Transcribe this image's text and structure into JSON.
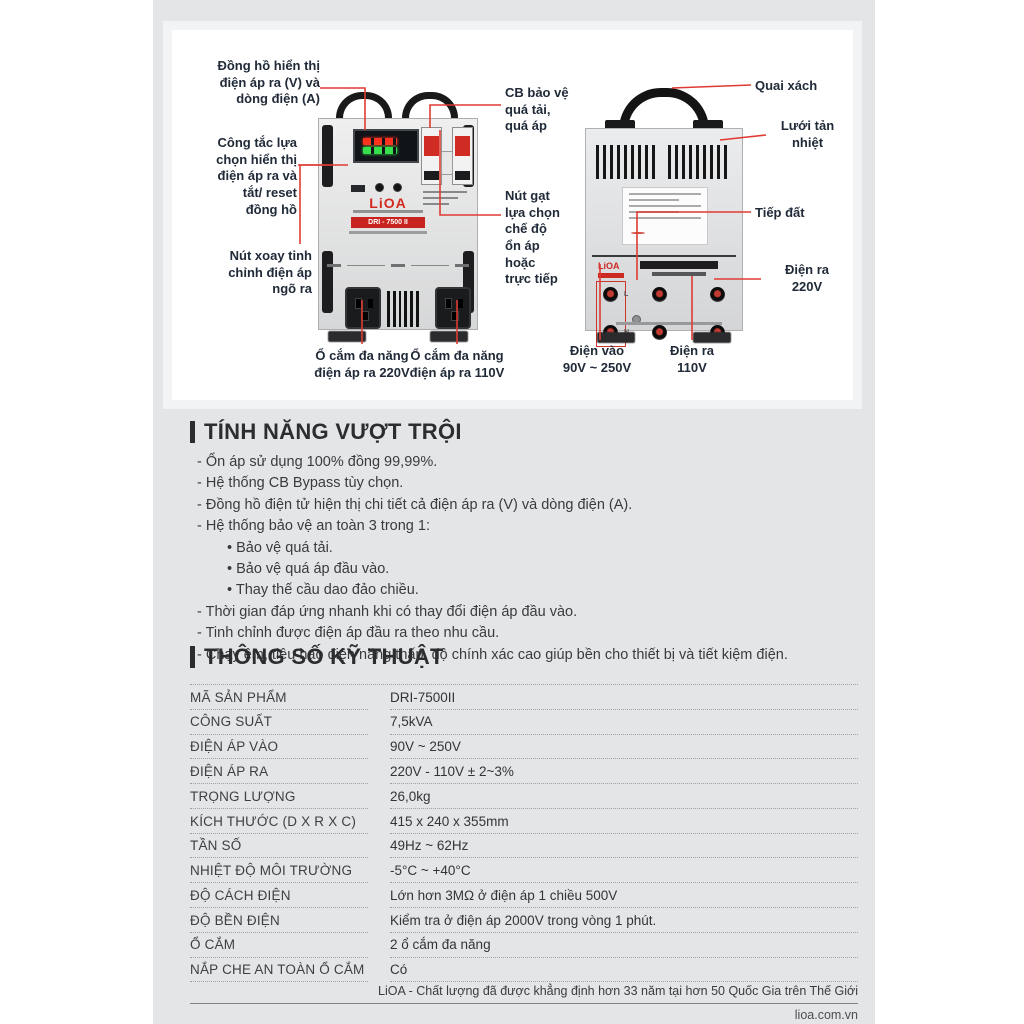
{
  "colors": {
    "accent_red": "#df3b33",
    "annotation_navy": "#202a38",
    "panel_gray": "#e4e5e7",
    "heading_dark": "#2b2d2f"
  },
  "device": {
    "front_logo": "LiOA",
    "front_model": "DRI - 7500 II",
    "back_logo": "LiOA"
  },
  "annotations": {
    "meter": "Đồng hồ hiển thị\nđiện áp ra (V) và\ndòng điện (A)",
    "selector_switch": "Công tắc lựa\nchọn hiển thị\nđiện áp ra và\ntắt/ reset\nđồng hồ",
    "tuning_knob": "Nút xoay tinh\nchỉnh điện áp\nngõ ra",
    "cb_protect": "CB bảo vệ\nquá tải,\nquá áp",
    "mode_switch": "Nút gạt\nlựa chọn\nchế độ\nổn áp\nhoặc\ntrực tiếp",
    "socket_220": "Ổ cắm đa năng\nđiện áp ra 220V",
    "socket_110": "Ổ cắm đa năng\nđiện áp ra 110V",
    "handle": "Quai xách",
    "vent_grid": "Lưới tản\nnhiệt",
    "ground": "Tiếp đất",
    "out_220": "Điện ra\n220V",
    "in_voltage": "Điện vào\n90V ~ 250V",
    "out_110": "Điện ra\n110V"
  },
  "features": {
    "title": "TÍNH NĂNG VƯỢT TRỘI",
    "items": [
      "- Ổn áp sử dụng 100% đồng 99,99%.",
      "- Hệ thống CB Bypass tùy chọn.",
      "- Đồng hồ điện tử hiện thị chi tiết cả điện áp ra (V) và dòng điện (A).",
      "- Hệ thống bảo vệ an toàn 3 trong 1:",
      "• Bảo vệ quá tải.",
      "• Bảo vệ quá áp đầu vào.",
      "• Thay thế cầu dao đảo chiều.",
      "- Thời gian đáp ứng nhanh khi có thay đổi điện áp đầu vào.",
      "- Tinh chỉnh được điện áp đầu ra theo nhu cầu.",
      "- Chạy êm, tiêu hao điện năng thấp, độ chính xác cao giúp bền cho thiết bị và tiết kiệm điện."
    ]
  },
  "specs": {
    "title": "THÔNG SỐ KỸ THUẬT",
    "rows": [
      {
        "label": "MÃ SẢN PHẨM",
        "value": "DRI-7500II"
      },
      {
        "label": "CÔNG SUẤT",
        "value": "7,5kVA"
      },
      {
        "label": "ĐIỆN ÁP VÀO",
        "value": "90V ~ 250V"
      },
      {
        "label": "ĐIỆN ÁP RA",
        "value": "220V - 110V ± 2~3%"
      },
      {
        "label": "TRỌNG LƯỢNG",
        "value": "26,0kg"
      },
      {
        "label": "KÍCH THƯỚC (D X R X C)",
        "value": "415 x 240 x 355mm"
      },
      {
        "label": "TẦN SỐ",
        "value": "49Hz ~ 62Hz"
      },
      {
        "label": "NHIỆT ĐỘ MÔI TRƯỜNG",
        "value": "-5°C ~ +40°C"
      },
      {
        "label": "ĐỘ CÁCH ĐIỆN",
        "value": "Lớn hơn 3MΩ ở điện áp 1 chiều 500V"
      },
      {
        "label": "ĐỘ BỀN ĐIỆN",
        "value": "Kiểm tra ở điện áp 2000V trong vòng 1 phút."
      },
      {
        "label": "Ổ CẮM",
        "value": "2 ổ cắm đa năng"
      },
      {
        "label": "NẮP CHE AN TOÀN Ổ CẮM",
        "value": "Có"
      }
    ]
  },
  "footer": {
    "tagline": "LiOA - Chất lượng đã được khẳng định hơn 33 năm tại hơn 50 Quốc Gia trên Thế Giới",
    "website": "lioa.com.vn"
  }
}
